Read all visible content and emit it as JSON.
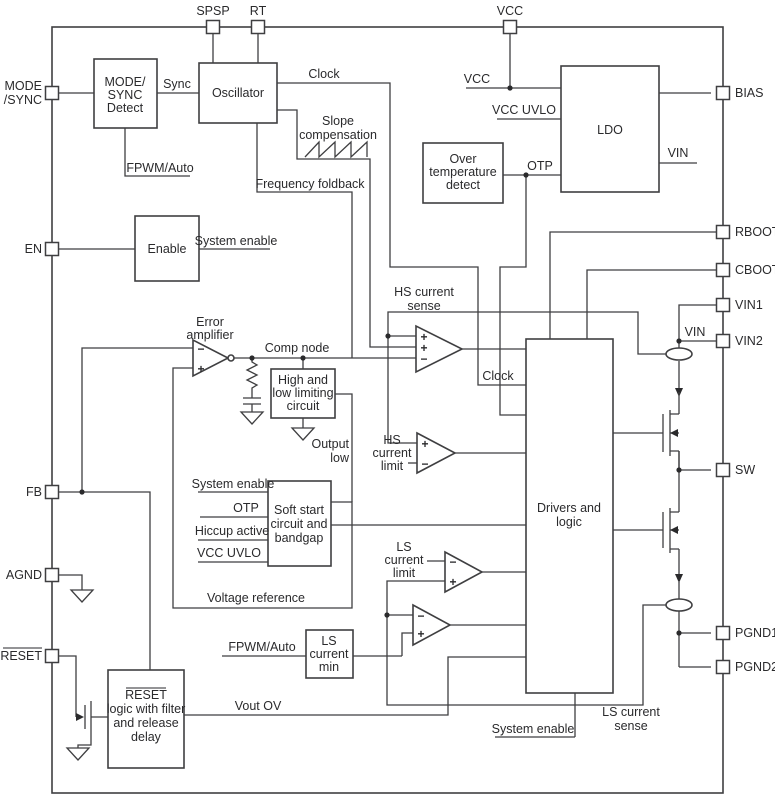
{
  "pins": {
    "spsp": "SPSP",
    "rt": "RT",
    "vcc": "VCC",
    "mode_sync": [
      "MODE",
      "/SYNC"
    ],
    "en": "EN",
    "fb": "FB",
    "agnd": "AGND",
    "reset": "RESET",
    "bias": "BIAS",
    "rboot": "RBOOT",
    "cboot": "CBOOT",
    "vin1": "VIN1",
    "vin2": "VIN2",
    "sw": "SW",
    "pgnd1": "PGND1",
    "pgnd2": "PGND2"
  },
  "blocks": {
    "mode_sync_detect": [
      "MODE/",
      "SYNC",
      "Detect"
    ],
    "oscillator": "Oscillator",
    "enable": "Enable",
    "ldo": "LDO",
    "over_temp": [
      "Over",
      "temperature",
      "detect"
    ],
    "limiting": [
      "High and",
      "low limiting",
      "circuit"
    ],
    "soft_start": [
      "Soft start",
      "circuit and",
      "bandgap"
    ],
    "ls_current_min": [
      "LS",
      "current",
      "min"
    ],
    "drivers": [
      "Drivers and",
      "logic"
    ],
    "reset_logic": [
      "RESET",
      "logic with filter",
      "and release",
      "delay"
    ]
  },
  "labels": {
    "sync": "Sync",
    "clock": "Clock",
    "clock2": "Clock",
    "slope_comp": [
      "Slope",
      "compensation"
    ],
    "freq_foldback": "Frequency foldback",
    "fpwm_auto_top": "FPWM/Auto",
    "fpwm_auto_bottom": "FPWM/Auto",
    "system_enable_top": "System enable",
    "system_enable_mid": "System enable",
    "system_enable_bottom": "System enable",
    "vcc": "VCC",
    "vcc_uvlo": "VCC UVLO",
    "vcc_uvlo2": "VCC UVLO",
    "otp": "OTP",
    "otp2": "OTP",
    "vin_ldo": "VIN",
    "vin_node": "VIN",
    "error_amp": [
      "Error",
      "amplifier"
    ],
    "comp_node": "Comp node",
    "output_low": [
      "Output",
      "low"
    ],
    "hiccup_active": "Hiccup active",
    "voltage_reference": "Voltage reference",
    "hs_current_sense": [
      "HS current",
      "sense"
    ],
    "hs_current_limit": [
      "HS",
      "current",
      "limit"
    ],
    "ls_current_limit": [
      "LS",
      "current",
      "limit"
    ],
    "ls_current_sense": [
      "LS current",
      "sense"
    ],
    "vout_ov": "Vout OV"
  },
  "sym": {
    "plus": "+",
    "minus": "−"
  }
}
